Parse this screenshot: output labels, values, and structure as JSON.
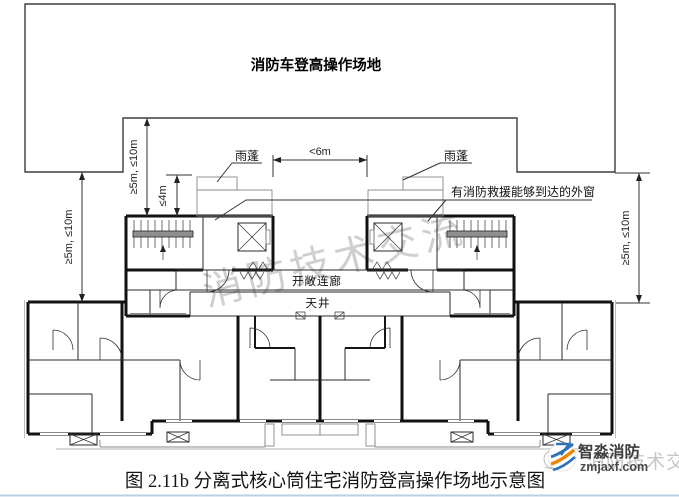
{
  "operation_area": {
    "label": "消防车登高操作场地"
  },
  "annotations": {
    "canopy_left": "雨蓬",
    "canopy_right": "雨蓬",
    "rescue_window": "有消防救援能够到达的外窗",
    "open_corridor": "开敞连廊",
    "light_well": "天井"
  },
  "dimensions": {
    "outer_left": "≥5m, ≤10m",
    "inner_left": "≥5m, ≤10m",
    "canopy_height": "≤4m",
    "core_gap": "<6m",
    "outer_right": "≥5m, ≤10m"
  },
  "watermark": {
    "center_text": "消防技术交流",
    "corner_text": "消防技术交流"
  },
  "logo": {
    "brand": "智淼消防",
    "website": "zmjaxf.com"
  },
  "caption": "图 2.11b 分离式核心筒住宅消防登高操作场地示意图",
  "colors": {
    "wall": "#111111",
    "dim_line": "#333333",
    "watermark": "#c4c4c4",
    "logo_blue": "#2e72b8",
    "logo_orange": "#f08300",
    "footer_rule": "#b9cfe6"
  }
}
